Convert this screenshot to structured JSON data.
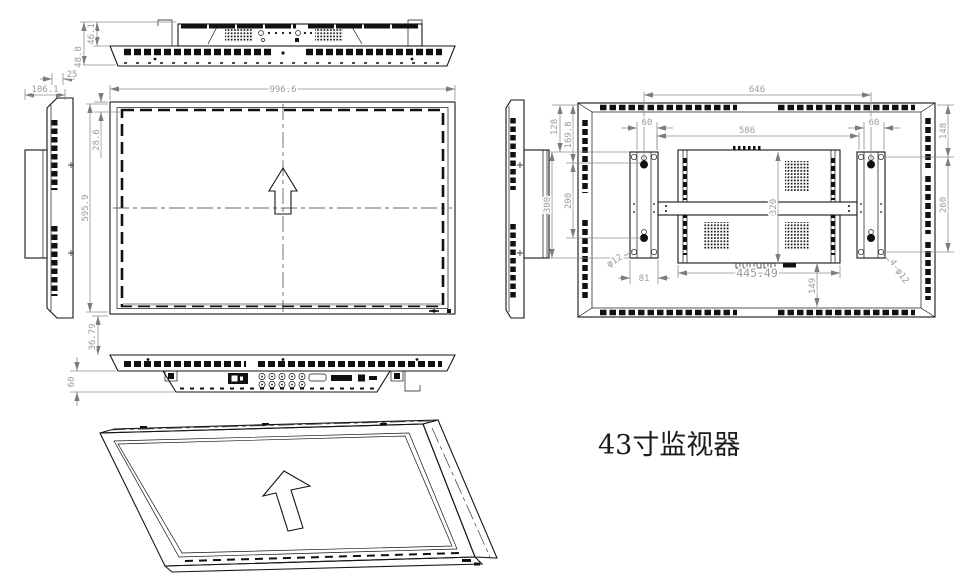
{
  "title": {
    "text": "43寸监视器"
  },
  "dims": {
    "d46_1": "46.1",
    "d48_8": "48.8",
    "d25": "25",
    "d106_1": "106.1",
    "d996_6": "996.6",
    "d28_6": "28.6",
    "d595_9": "595.9",
    "d36_79": "36.79",
    "d60b": "60",
    "d646": "646",
    "d586": "586",
    "d60L": "60",
    "d60R": "60",
    "d128": "128",
    "d169_8": "169.8",
    "d300": "300",
    "d200": "200",
    "d148": "148",
    "d260": "260",
    "d320": "320",
    "d445_49": "445.49",
    "d149": "149",
    "d81": "81",
    "dphi12": "φ12",
    "d4phi12": "4-φ12"
  }
}
